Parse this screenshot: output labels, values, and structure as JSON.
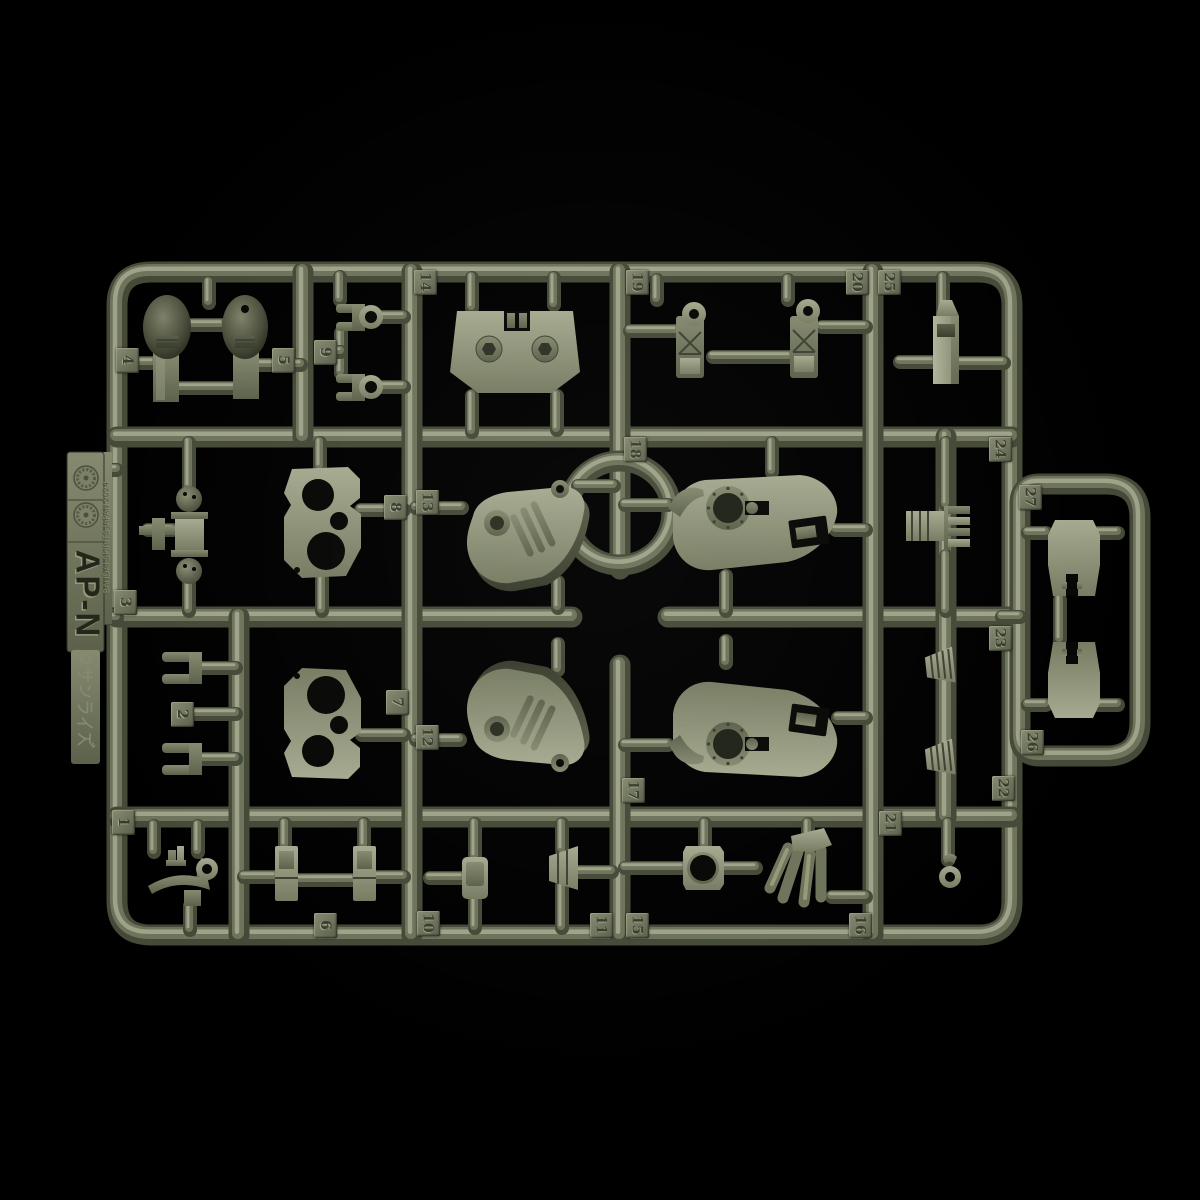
{
  "scene": {
    "type": "product photo",
    "subject": "injection-molded plastic model kit runner (sprue) with numbered parts",
    "background_color": "#000000"
  },
  "sprue": {
    "runner_code": "AP-N",
    "copyright": "©サンライズ",
    "mold_text": "BANDAI SPIRITS JAPAN 2024",
    "plastic_color_name": "olive green",
    "part_count": 27,
    "part_numbers": [
      "1",
      "2",
      "3",
      "4",
      "5",
      "6",
      "7",
      "8",
      "9",
      "10",
      "11",
      "12",
      "13",
      "14",
      "15",
      "16",
      "17",
      "18",
      "19",
      "20",
      "21",
      "22",
      "23",
      "24",
      "25",
      "26",
      "27"
    ],
    "details": {
      "date_wheels": 2,
      "center_ring": true
    },
    "colors": {
      "runner_base": "#454a38",
      "runner_mid": "#6e735b",
      "runner_highlight": "#9da289",
      "part_light": "#8e927c",
      "part_mid": "#6f745e",
      "part_dark": "#4a4e3c",
      "background": "#000000"
    }
  }
}
